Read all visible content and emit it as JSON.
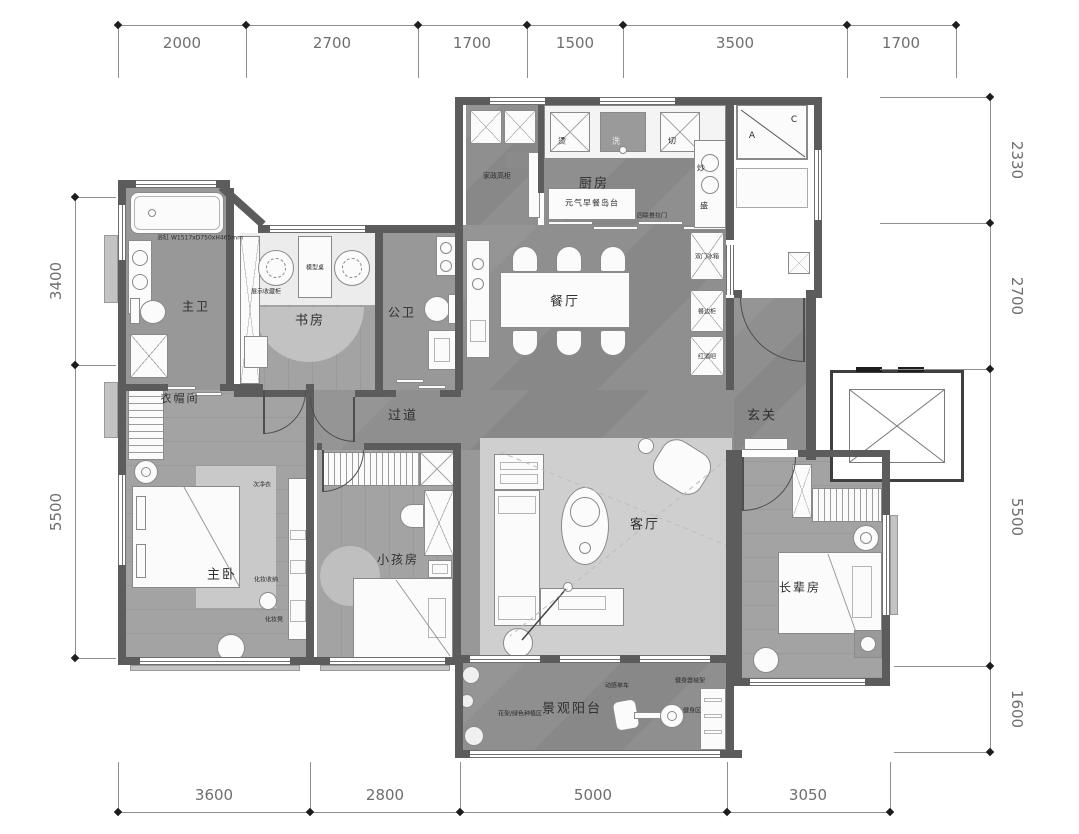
{
  "dimensions_mm": {
    "top": [
      "2000",
      "2700",
      "1700",
      "1500",
      "3500",
      "1700"
    ],
    "bottom": [
      "3600",
      "2800",
      "5000",
      "3050"
    ],
    "left": [
      "3400",
      "5500"
    ],
    "right": [
      "2330",
      "2700",
      "5500",
      "1600"
    ]
  },
  "rooms": {
    "kitchen": "厨房",
    "dining": "餐厅",
    "master_bath": "主卫",
    "study": "书房",
    "guest_bath": "公卫",
    "cloakroom": "衣帽间",
    "hallway": "过道",
    "foyer": "玄关",
    "master_bedroom": "主卧",
    "kids_room": "小孩房",
    "living_room": "客厅",
    "elders_room": "长辈房",
    "balcony": "景观阳台"
  },
  "annotations": {
    "breakfast_island": "元气早餐岛台",
    "housekeeping_cabinet": "家政高柜",
    "station_iron": "烫",
    "station_wash": "洗",
    "station_cut": "切",
    "station_fry": "炒",
    "station_serve": "盛",
    "sliding_door": "四联推拉门",
    "fridge": "双门冰箱",
    "sideboard": "餐边柜",
    "wine_bar": "红酒吧",
    "model_table": "模型桌",
    "display_cabinet": "展示收藏柜",
    "bathtub_spec": "浴缸 W1517xD750xH465mm",
    "laundry_clothes": "次净衣",
    "makeup_storage": "化妆收纳",
    "makeup_stool": "化妆凳",
    "ac_label_a": "A",
    "ac_label_c": "C",
    "plant_zone": "花架/绿色种植区",
    "spin_bike": "动感单车",
    "equipment_rack": "健身器械架",
    "fitness_zone": "健身区"
  }
}
